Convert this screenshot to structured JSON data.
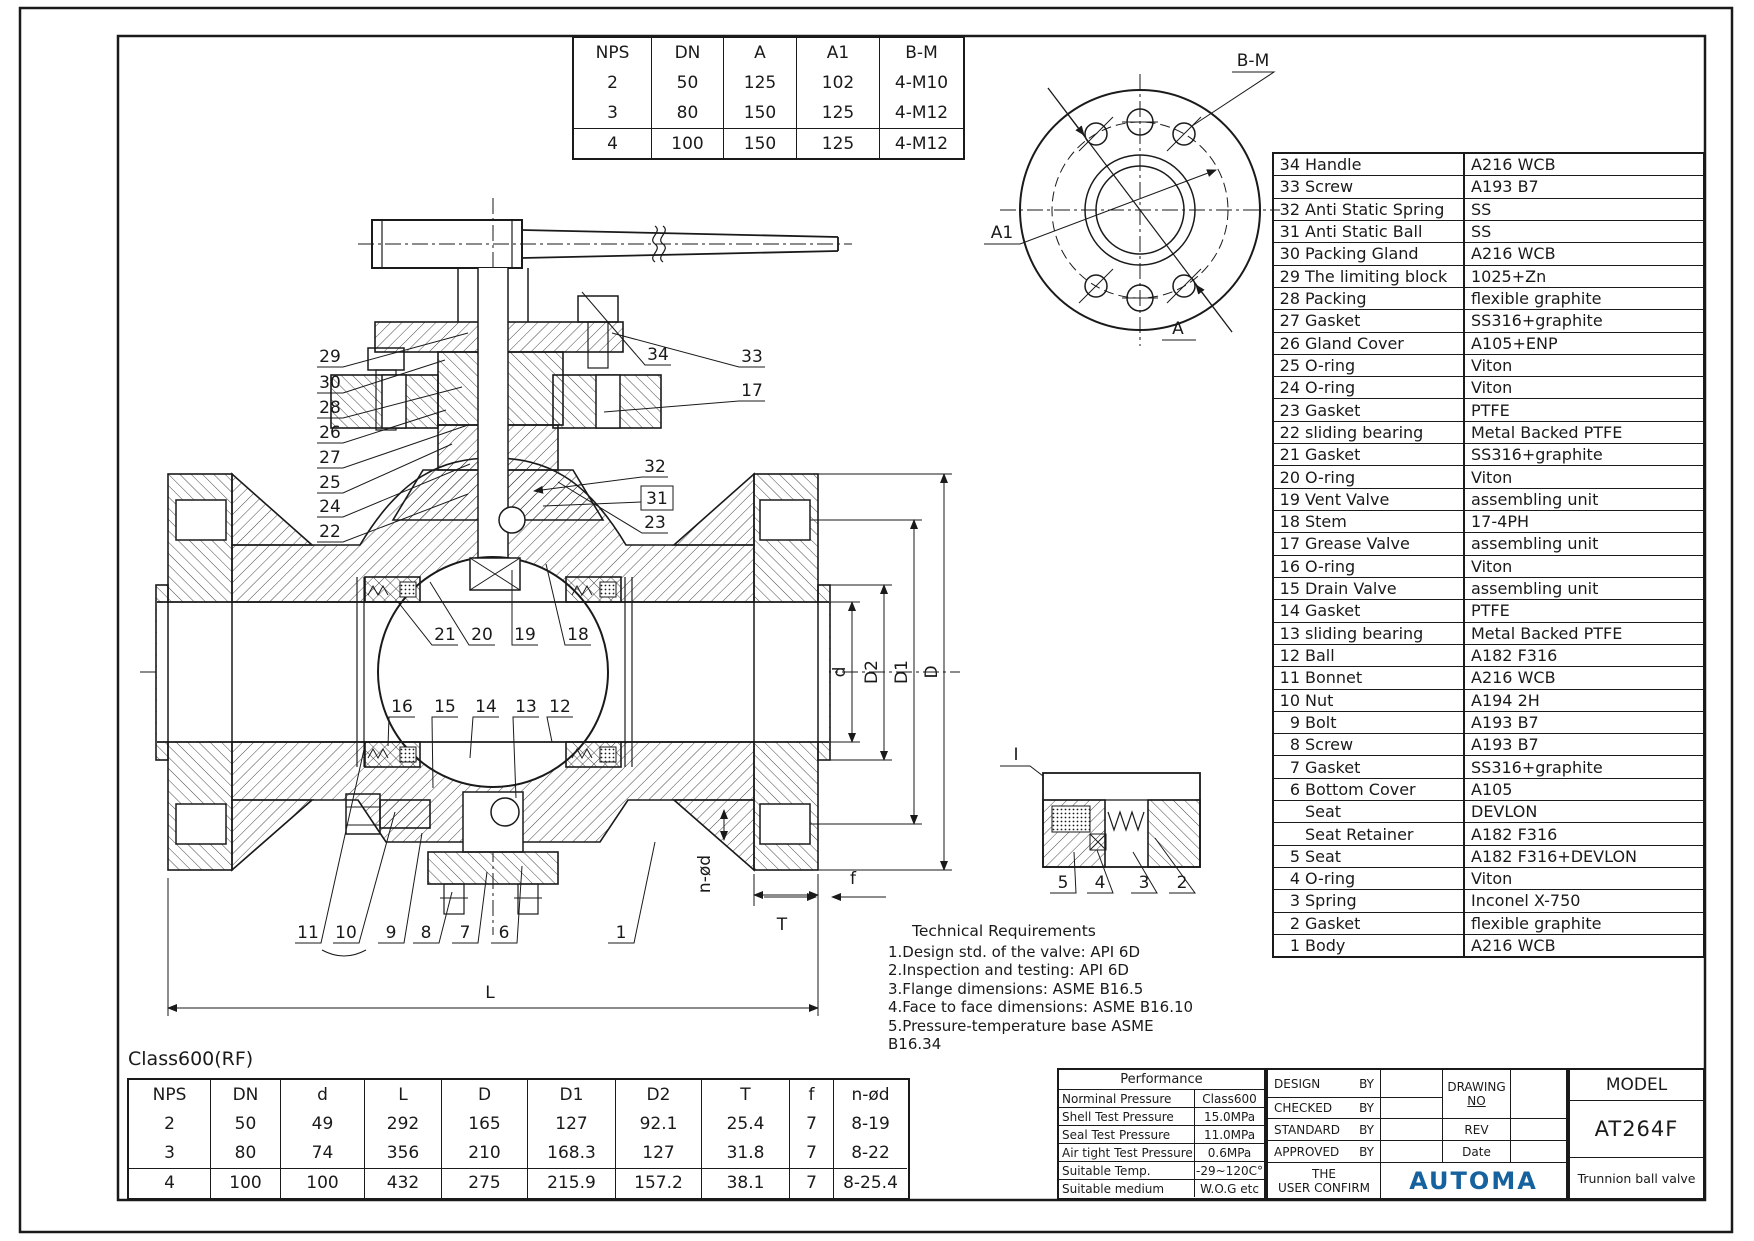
{
  "sheet": {
    "class_rating": "Class600(RF)"
  },
  "flange_table": {
    "headers": [
      "NPS",
      "DN",
      "A",
      "A1",
      "B-M"
    ],
    "rows": [
      [
        "2",
        "50",
        "125",
        "102",
        "4-M10"
      ],
      [
        "3",
        "80",
        "150",
        "125",
        "4-M12"
      ],
      [
        "4",
        "100",
        "150",
        "125",
        "4-M12"
      ]
    ]
  },
  "flange_view": {
    "bm": "B-M",
    "a1": "A1",
    "a": "A"
  },
  "parts_list": {
    "rows": [
      {
        "no": "34",
        "name": "Handle",
        "mat": "A216 WCB"
      },
      {
        "no": "33",
        "name": "Screw",
        "mat": "A193 B7"
      },
      {
        "no": "32",
        "name": "Anti Static Spring",
        "mat": "SS"
      },
      {
        "no": "31",
        "name": "Anti Static Ball",
        "mat": "SS"
      },
      {
        "no": "30",
        "name": "Packing Gland",
        "mat": "A216 WCB"
      },
      {
        "no": "29",
        "name": "The limiting block",
        "mat": "1025+Zn"
      },
      {
        "no": "28",
        "name": "Packing",
        "mat": "flexible graphite"
      },
      {
        "no": "27",
        "name": "Gasket",
        "mat": "SS316+graphite"
      },
      {
        "no": "26",
        "name": "Gland Cover",
        "mat": "A105+ENP"
      },
      {
        "no": "25",
        "name": "O-ring",
        "mat": "Viton"
      },
      {
        "no": "24",
        "name": "O-ring",
        "mat": "Viton"
      },
      {
        "no": "23",
        "name": "Gasket",
        "mat": "PTFE"
      },
      {
        "no": "22",
        "name": "sliding bearing",
        "mat": "Metal Backed PTFE"
      },
      {
        "no": "21",
        "name": "Gasket",
        "mat": "SS316+graphite"
      },
      {
        "no": "20",
        "name": "O-ring",
        "mat": "Viton"
      },
      {
        "no": "19",
        "name": "Vent Valve",
        "mat": "assembling unit"
      },
      {
        "no": "18",
        "name": "Stem",
        "mat": "17-4PH"
      },
      {
        "no": "17",
        "name": "Grease Valve",
        "mat": "assembling unit"
      },
      {
        "no": "16",
        "name": "O-ring",
        "mat": "Viton"
      },
      {
        "no": "15",
        "name": "Drain Valve",
        "mat": "assembling unit"
      },
      {
        "no": "14",
        "name": "Gasket",
        "mat": "PTFE"
      },
      {
        "no": "13",
        "name": "sliding bearing",
        "mat": "Metal Backed PTFE"
      },
      {
        "no": "12",
        "name": "Ball",
        "mat": "A182 F316"
      },
      {
        "no": "11",
        "name": "Bonnet",
        "mat": "A216 WCB"
      },
      {
        "no": "10",
        "name": "Nut",
        "mat": "A194 2H"
      },
      {
        "no": "9",
        "name": "Bolt",
        "mat": "A193 B7"
      },
      {
        "no": "8",
        "name": "Screw",
        "mat": "A193 B7"
      },
      {
        "no": "7",
        "name": "Gasket",
        "mat": "SS316+graphite"
      },
      {
        "no": "6",
        "name": "Bottom Cover",
        "mat": "A105"
      },
      {
        "no": "",
        "name": "Seat",
        "mat": "DEVLON"
      },
      {
        "no": "",
        "name": "Seat Retainer",
        "mat": "A182 F316"
      },
      {
        "no": "5",
        "name": "Seat",
        "mat": "A182 F316+DEVLON"
      },
      {
        "no": "4",
        "name": "O-ring",
        "mat": "Viton"
      },
      {
        "no": "3",
        "name": "Spring",
        "mat": "Inconel X-750"
      },
      {
        "no": "2",
        "name": "Gasket",
        "mat": "flexible graphite"
      },
      {
        "no": "1",
        "name": "Body",
        "mat": "A216 WCB"
      }
    ]
  },
  "drawing": {
    "callouts": {
      "c34": "34",
      "c33": "33",
      "c32": "32",
      "c31": "31",
      "c30": "30",
      "c29": "29",
      "c28": "28",
      "c27": "27",
      "c26": "26",
      "c25": "25",
      "c24": "24",
      "c23": "23",
      "c22": "22",
      "c21": "21",
      "c20": "20",
      "c19": "19",
      "c18": "18",
      "c17": "17",
      "c16": "16",
      "c15": "15",
      "c14": "14",
      "c13": "13",
      "c12": "12",
      "c11": "11",
      "c10": "10",
      "c9": "9",
      "c8": "8",
      "c7": "7",
      "c6": "6",
      "c5": "5",
      "c4": "4",
      "c3": "3",
      "c2": "2",
      "c1": "1"
    },
    "dims": {
      "d": "d",
      "D2": "D2",
      "D1": "D1",
      "D": "D",
      "T": "T",
      "f": "f",
      "nod": "n-ød",
      "L": "L"
    },
    "detail_label": "I"
  },
  "tech_req": {
    "title": "Technical Requirements",
    "items": [
      "1.Design std. of the valve: API 6D",
      "2.Inspection and testing: API 6D",
      "3.Flange dimensions: ASME B16.5",
      "4.Face to face dimensions: ASME B16.10",
      "5.Pressure-temperature base ASME B16.34"
    ]
  },
  "dim_table": {
    "headers": [
      "NPS",
      "DN",
      "d",
      "L",
      "D",
      "D1",
      "D2",
      "T",
      "f",
      "n-ød"
    ],
    "rows": [
      [
        "2",
        "50",
        "49",
        "292",
        "165",
        "127",
        "92.1",
        "25.4",
        "7",
        "8-19"
      ],
      [
        "3",
        "80",
        "74",
        "356",
        "210",
        "168.3",
        "127",
        "31.8",
        "7",
        "8-22"
      ],
      [
        "4",
        "100",
        "100",
        "432",
        "275",
        "215.9",
        "157.2",
        "38.1",
        "7",
        "8-25.4"
      ]
    ]
  },
  "performance": {
    "title": "Performance",
    "rows": [
      [
        "Norminal Pressure",
        "Class600"
      ],
      [
        "Shell Test Pressure",
        "15.0MPa"
      ],
      [
        "Seal Test Pressure",
        "11.0MPa"
      ],
      [
        "Air tight Test Pressure",
        "0.6MPa"
      ],
      [
        "Suitable Temp.",
        "-29~120C°"
      ],
      [
        "Suitable medium",
        "W.O.G etc"
      ]
    ]
  },
  "title_block": {
    "sign_rows": [
      "DESIGN",
      "CHECKED",
      "STANDARD",
      "APPROVED"
    ],
    "by": "BY",
    "user_confirm_1": "THE",
    "user_confirm_2": "USER CONFIRM",
    "drawing_no_1": "DRAWING",
    "drawing_no_2": "NO",
    "rev": "REV",
    "date": "Date",
    "model_label": "MODEL",
    "model": "AT264F",
    "logo": "AUTOMA",
    "product": "Trunnion ball valve"
  },
  "colors": {
    "line": "#1a1a1a",
    "logo_blue": "#16629e"
  }
}
